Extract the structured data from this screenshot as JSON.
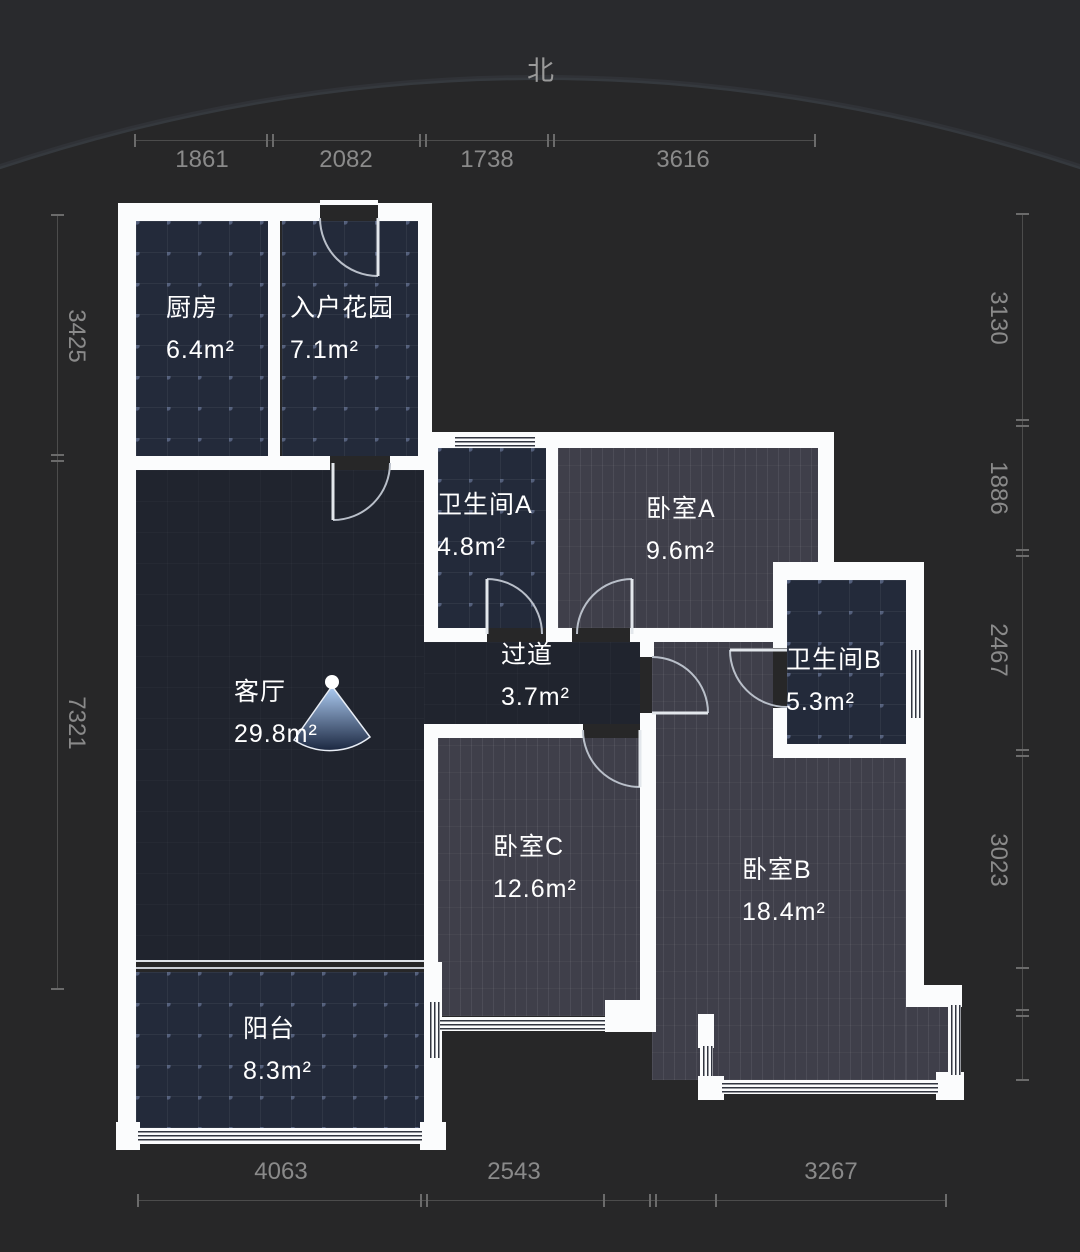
{
  "north_label": "北",
  "rooms": [
    {
      "name": "厨房",
      "area": "6.4m²"
    },
    {
      "name": "入户花园",
      "area": "7.1m²"
    },
    {
      "name": "卫生间A",
      "area": "4.8m²"
    },
    {
      "name": "卧室A",
      "area": "9.6m²"
    },
    {
      "name": "过道",
      "area": "3.7m²"
    },
    {
      "name": "客厅",
      "area": "29.8m²"
    },
    {
      "name": "卫生间B",
      "area": "5.3m²"
    },
    {
      "name": "卧室C",
      "area": "12.6m²"
    },
    {
      "name": "卧室B",
      "area": "18.4m²"
    },
    {
      "name": "阳台",
      "area": "8.3m²"
    }
  ],
  "dimensions": {
    "top": [
      "1861",
      "2082",
      "1738",
      "3616"
    ],
    "bottom": [
      "4063",
      "2543",
      "3267"
    ],
    "left": [
      "3425",
      "7321"
    ],
    "right": [
      "3130",
      "1886",
      "2467",
      "3023"
    ]
  },
  "colors": {
    "background": "#272728",
    "wall": "#fbfcfd",
    "tile_floor": "#232a3a",
    "wood_floor": "#3f3f4a",
    "living_floor": "#20242e",
    "dimension_text": "#8a8a8a",
    "room_text": "#ffffff",
    "door_arc": "#b9bfc9",
    "camera_marker": "#8db5ea"
  }
}
